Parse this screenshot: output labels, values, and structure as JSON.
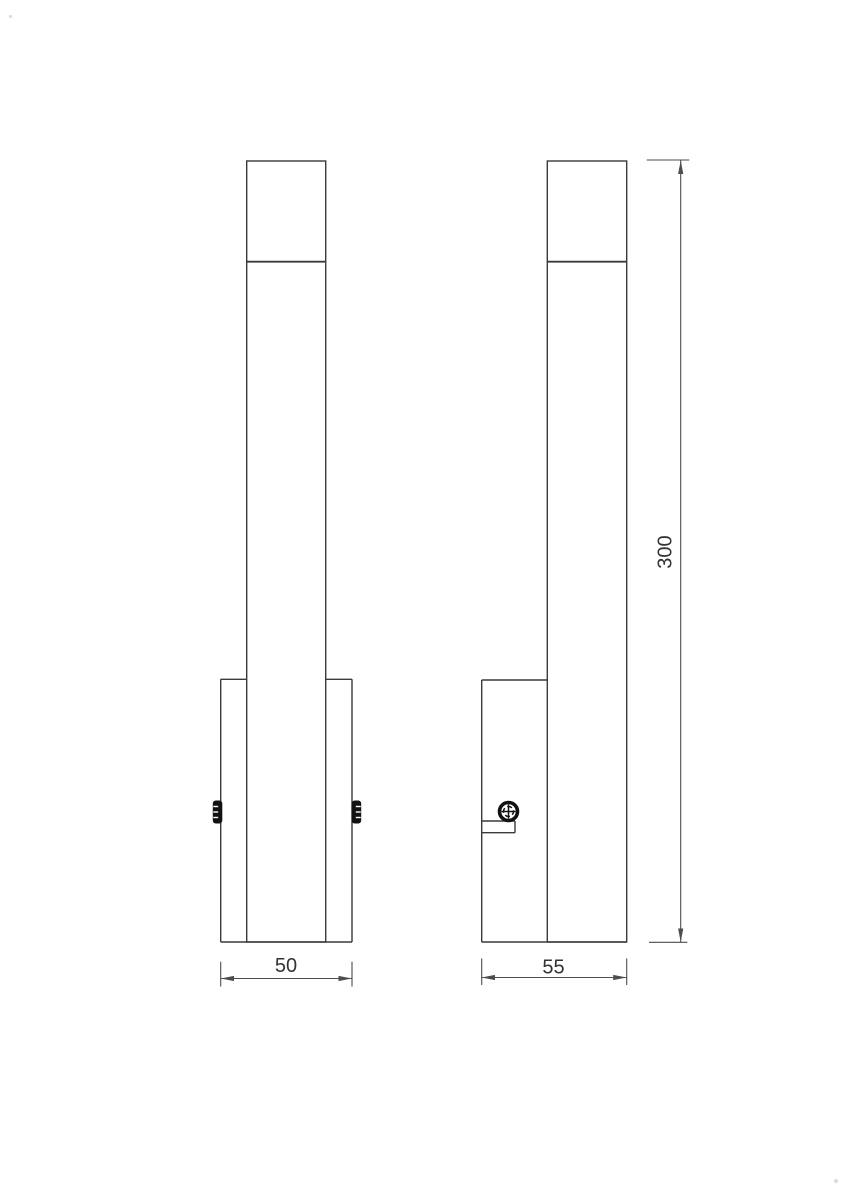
{
  "drawing": {
    "colors": {
      "bg": "#ffffff",
      "outline": "#3a3a3a",
      "dim": "#4d4d4d",
      "text": "#333333",
      "screw": "#121212"
    },
    "dimensions": {
      "width": {
        "label": "50"
      },
      "depth": {
        "label": "55"
      },
      "height": {
        "label": "300"
      }
    }
  }
}
